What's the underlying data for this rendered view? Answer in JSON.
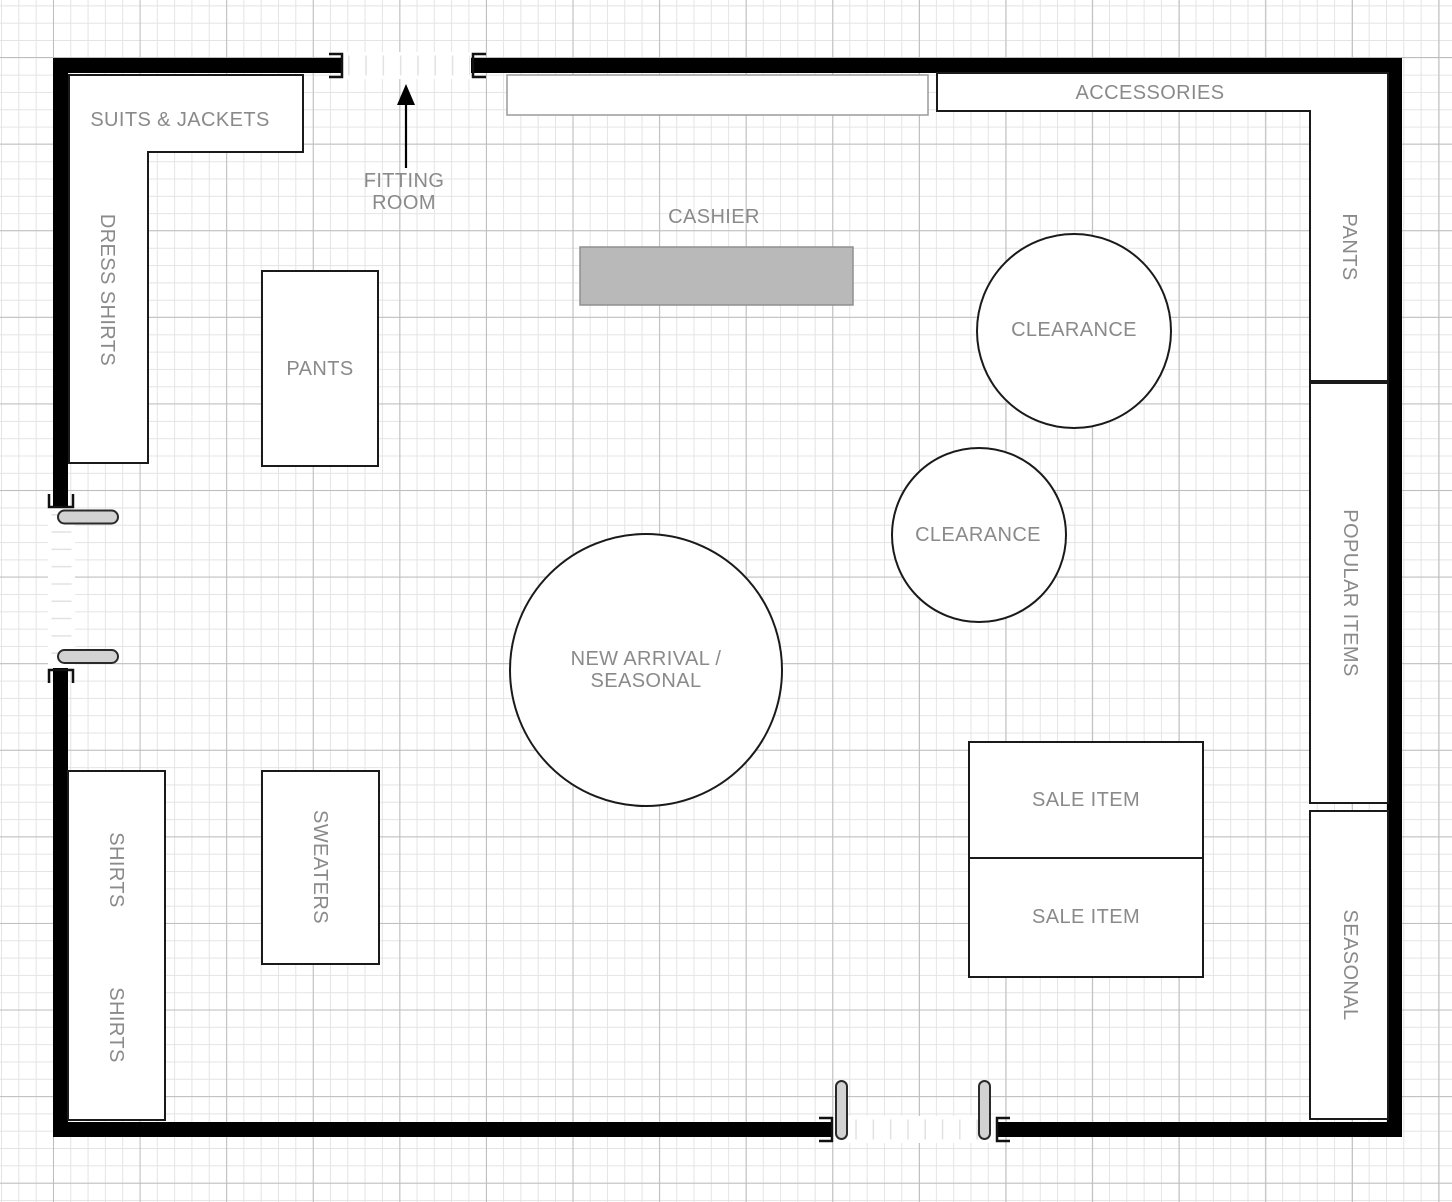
{
  "diagram": {
    "title": "store-floor-plan",
    "labels": {
      "suits_jackets": "SUITS & JACKETS",
      "dress_shirts": "DRESS SHIRTS",
      "fitting_room": "FITTING\nROOM",
      "cashier": "CASHIER",
      "accessories": "ACCESSORIES",
      "pants_wall": "PANTS",
      "clearance_1": "CLEARANCE",
      "clearance_2": "CLEARANCE",
      "new_arrival_seasonal": "NEW ARRIVAL /\nSEASONAL",
      "pants_table": "PANTS",
      "popular_items": "POPULAR ITEMS",
      "seasonal_wall": "SEASONAL",
      "sale_item_1": "SALE ITEM",
      "sale_item_2": "SALE ITEM",
      "shirts_upper": "SHIRTS",
      "shirts_lower": "SHIRTS",
      "sweaters": "SWEATERS"
    },
    "colors": {
      "wall": "#000000",
      "fixture_fill": "#ffffff",
      "fixture_stroke": "#1a1a1a",
      "cashier_fill": "#b9b9b9",
      "door_marker_fill": "#d2d2d2",
      "label_text": "#8a8a8a",
      "grid_minor": "#e4e4e4",
      "grid_major": "#bdbdbd"
    }
  }
}
